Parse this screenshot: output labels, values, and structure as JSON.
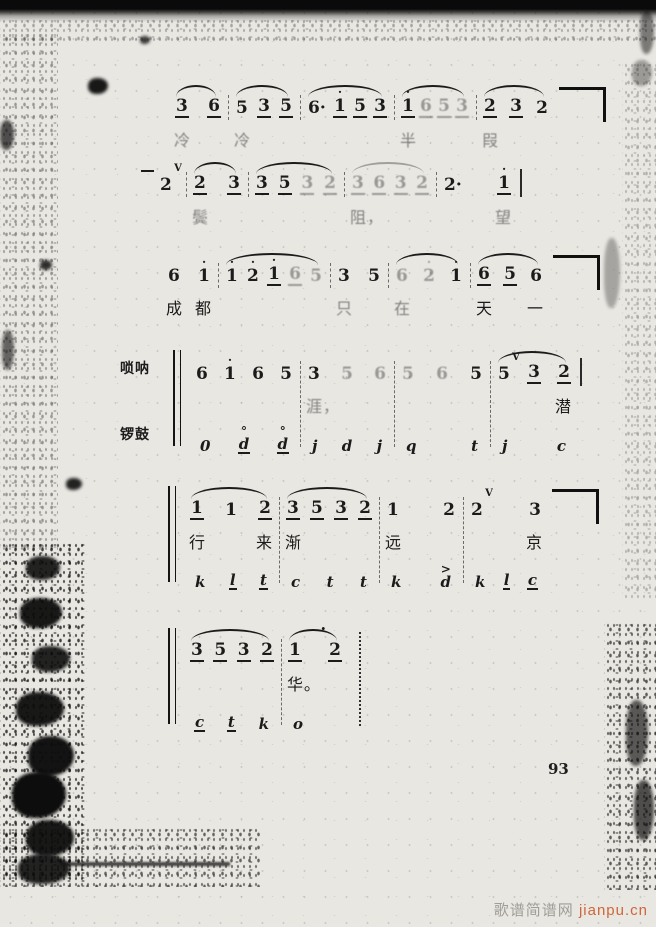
{
  "page": {
    "number": "93"
  },
  "watermark": {
    "site_name": "歌谱简谱网",
    "site_url": "jianpu.cn"
  },
  "music": {
    "notation": "jianpu",
    "systems": [
      {
        "right": "corner",
        "measures": [
          {
            "w": 60,
            "slur": true,
            "notes": [
              {
                "t": "3",
                "u": 1
              },
              {
                "t": "6",
                "u": 1
              }
            ],
            "lyric": "冷",
            "lf": true
          },
          {
            "w": 72,
            "slur": true,
            "notes": [
              {
                "t": "5"
              },
              {
                "t": "3",
                "u": 1
              },
              {
                "t": "5",
                "u": 1
              }
            ],
            "lyric": "冷",
            "lf": true
          },
          {
            "w": 94,
            "slur": true,
            "notes": [
              {
                "t": "6",
                "ad": 1
              },
              {
                "t": "1",
                "hd": 1,
                "u": 1
              },
              {
                "t": "5",
                "u": 1
              },
              {
                "t": "3",
                "u": 1
              }
            ],
            "lyric": ""
          },
          {
            "w": 82,
            "slur": true,
            "notes": [
              {
                "t": "1",
                "hd": 1,
                "u": 1
              },
              {
                "t": "6",
                "u": 1,
                "f": 1
              },
              {
                "t": "5",
                "u": 1,
                "f": 1
              },
              {
                "t": "3",
                "u": 1,
                "f": 1
              }
            ],
            "lyric": "半",
            "lf": true
          },
          {
            "w": 80,
            "slur": true,
            "notes": [
              {
                "t": "2",
                "u": 1
              },
              {
                "t": "3",
                "u": 1
              },
              {
                "t": "2"
              }
            ],
            "lyric": "叚",
            "lf": true
          }
        ]
      },
      {
        "right": "bar",
        "measures": [
          {
            "w": 34,
            "notes": [
              {
                "t": "2",
                "v": 1,
                "preTie": 1
              }
            ],
            "lyric": ""
          },
          {
            "w": 62,
            "slur": true,
            "notes": [
              {
                "t": "2",
                "u": 1
              },
              {
                "t": "3",
                "u": 1
              }
            ],
            "lyric": "鬓",
            "lf": true
          },
          {
            "w": 96,
            "slur": true,
            "notes": [
              {
                "t": "3",
                "u": 1
              },
              {
                "t": "5",
                "u": 1
              },
              {
                "t": "3",
                "u": 1,
                "f": 1
              },
              {
                "t": "2",
                "u": 1,
                "f": 1
              }
            ],
            "lyric": ""
          },
          {
            "w": 92,
            "slur": true,
            "sf": 1,
            "notes": [
              {
                "t": "3",
                "u": 1,
                "f": 1
              },
              {
                "t": "6",
                "u": 1,
                "f": 1
              },
              {
                "t": "3",
                "u": 1,
                "f": 1
              },
              {
                "t": "2",
                "u": 1,
                "f": 1
              }
            ],
            "lyric": "阻，",
            "lf": true
          },
          {
            "w": 82,
            "notes": [
              {
                "t": "2",
                "ad": 1
              },
              {
                "t": "1",
                "hd": 1,
                "u": 1
              }
            ],
            "lyric": "望",
            "la": "r",
            "lf": true
          }
        ]
      },
      {
        "right": "corner",
        "measures": [
          {
            "w": 58,
            "notes": [
              {
                "t": "6"
              },
              {
                "t": "1",
                "hd": 1
              }
            ],
            "lyric": "成 都",
            "la": "s"
          },
          {
            "w": 112,
            "slur": true,
            "notes": [
              {
                "t": "1",
                "hd": 1
              },
              {
                "t": "2",
                "hd": 1
              },
              {
                "t": "1",
                "hd": 1,
                "u": 1
              },
              {
                "t": "6",
                "u": 1,
                "f": 1
              },
              {
                "t": "5",
                "f": 1
              }
            ],
            "lyric": ""
          },
          {
            "w": 58,
            "notes": [
              {
                "t": "3"
              },
              {
                "t": "5"
              }
            ],
            "lyric": "只",
            "lf": true
          },
          {
            "w": 82,
            "slur": true,
            "notes": [
              {
                "t": "6",
                "f": 1
              },
              {
                "t": "2",
                "hd": 1,
                "f": 1
              },
              {
                "t": "1",
                "hd": 1
              }
            ],
            "lyric": "在",
            "lf": true
          },
          {
            "w": 80,
            "slur": true,
            "notes": [
              {
                "t": "6",
                "u": 1
              },
              {
                "t": "5",
                "u": 1
              },
              {
                "t": "6"
              }
            ],
            "lyric": "天 一",
            "la": "s"
          }
        ]
      },
      {
        "labels": [
          "唢呐",
          "锣鼓"
        ],
        "bracket": true,
        "tall": true,
        "right": "bar",
        "measures": [
          {
            "w": 112,
            "notes": [
              {
                "t": "6"
              },
              {
                "t": "1",
                "hd": 1
              },
              {
                "t": "6"
              },
              {
                "t": "5"
              }
            ],
            "lyric": "",
            "perc": [
              {
                "t": "0"
              },
              {
                "t": "d",
                "ring": 1,
                "u": 1
              },
              {
                "t": "d",
                "ring": 1,
                "u": 1
              }
            ]
          },
          {
            "w": 94,
            "notes": [
              {
                "t": "3"
              },
              {
                "t": "5",
                "f": 1
              },
              {
                "t": "6",
                "f": 1
              }
            ],
            "lyric": "涯，",
            "lf": true,
            "perc": [
              {
                "t": "j"
              },
              {
                "t": "d"
              },
              {
                "t": "j"
              }
            ]
          },
          {
            "w": 96,
            "notes": [
              {
                "t": "5",
                "f": 1
              },
              {
                "t": "6",
                "f": 1
              },
              {
                "t": "5"
              }
            ],
            "lyric": "",
            "perc": [
              {
                "t": "q"
              },
              {
                "t": "t"
              }
            ]
          },
          {
            "w": 88,
            "slur": true,
            "notes": [
              {
                "t": "5",
                "v": 1
              },
              {
                "t": "3",
                "u": 1
              },
              {
                "t": "2",
                "u": 1
              }
            ],
            "lyric": "潜",
            "la": "r",
            "perc": [
              {
                "t": "j"
              },
              {
                "t": "c"
              }
            ]
          }
        ]
      },
      {
        "bracket": true,
        "tall": true,
        "right": "corner",
        "measures": [
          {
            "w": 96,
            "slur": true,
            "notes": [
              {
                "t": "1",
                "u": 1
              },
              {
                "t": "1"
              },
              {
                "t": "2",
                "u": 1
              }
            ],
            "lyric": "行 来",
            "la": "s",
            "perc": [
              {
                "t": "k"
              },
              {
                "t": "l",
                "u": 1
              },
              {
                "t": "t",
                "u": 1
              }
            ]
          },
          {
            "w": 100,
            "slur": true,
            "notes": [
              {
                "t": "3",
                "u": 1
              },
              {
                "t": "5",
                "u": 1
              },
              {
                "t": "3",
                "u": 1
              },
              {
                "t": "2",
                "u": 1
              }
            ],
            "lyric": "渐",
            "perc": [
              {
                "t": "c"
              },
              {
                "t": "t"
              },
              {
                "t": "t"
              }
            ]
          },
          {
            "w": 84,
            "notes": [
              {
                "t": "1"
              },
              {
                "t": "2"
              }
            ],
            "lyric": "远",
            "perc": [
              {
                "t": "k"
              },
              {
                "t": "d",
                "acc": 1
              }
            ]
          },
          {
            "w": 86,
            "notes": [
              {
                "t": "2",
                "v": 1
              },
              {
                "t": "3"
              }
            ],
            "lyric": "京",
            "la": "r",
            "perc": [
              {
                "t": "k"
              },
              {
                "t": "l",
                "u": 1
              },
              {
                "t": "c",
                "u": 1
              }
            ]
          }
        ]
      },
      {
        "bracket": true,
        "tall": true,
        "right": "dotted",
        "measures": [
          {
            "w": 98,
            "slur": true,
            "notes": [
              {
                "t": "3",
                "u": 1
              },
              {
                "t": "5",
                "u": 1
              },
              {
                "t": "3",
                "u": 1
              },
              {
                "t": "2",
                "u": 1
              }
            ],
            "lyric": "",
            "perc": [
              {
                "t": "c",
                "u": 1
              },
              {
                "t": "t",
                "u": 1
              },
              {
                "t": "k"
              }
            ]
          },
          {
            "w": 68,
            "slur": true,
            "ferm": 1,
            "notes": [
              {
                "t": "1",
                "u": 1
              },
              {
                "t": "2",
                "u": 1
              }
            ],
            "lyric": "华。",
            "perc": [
              {
                "t": "o"
              }
            ]
          }
        ]
      }
    ]
  }
}
